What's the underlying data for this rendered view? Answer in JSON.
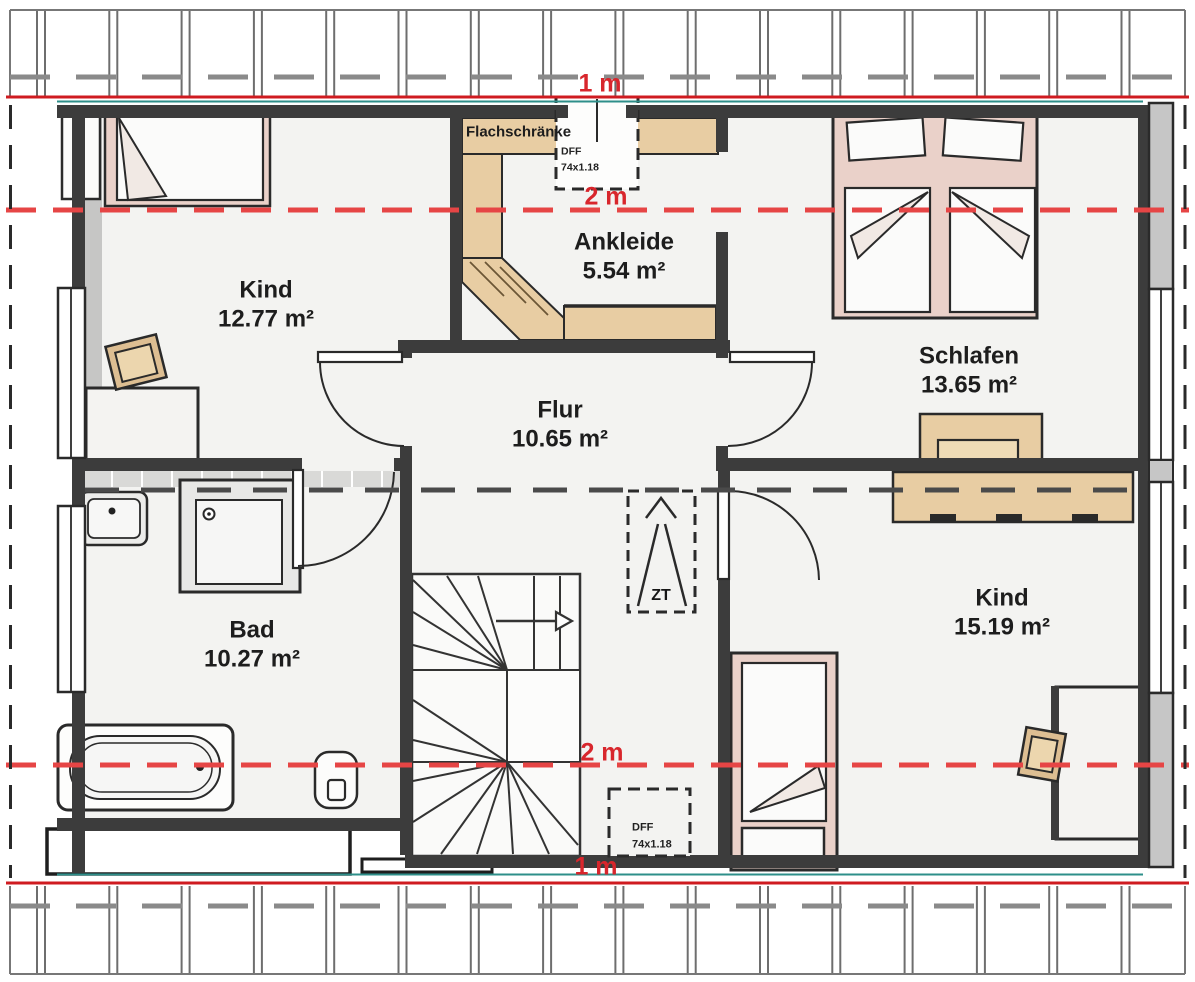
{
  "rooms": [
    {
      "name": "Kind",
      "area": "12.77 m²"
    },
    {
      "name": "Ankleide",
      "area": "5.54 m²"
    },
    {
      "name": "Schlafen",
      "area": "13.65 m²"
    },
    {
      "name": "Flur",
      "area": "10.65 m²"
    },
    {
      "name": "Bad",
      "area": "10.27 m²"
    },
    {
      "name": "Kind",
      "area": "15.19 m²"
    }
  ],
  "labels": {
    "flat_cabinets": "Flachschränke",
    "roof_hatch": "ZT"
  },
  "roof_windows": {
    "top": {
      "code": "DFF",
      "size": "74x1.18"
    },
    "bottom": {
      "code": "DFF",
      "size": "74x1.18"
    }
  },
  "height_marks": {
    "top_1m": "1 m",
    "top_2m": "2 m",
    "mid_2m": "2 m",
    "bottom_1m": "1 m"
  },
  "colors": {
    "red_solid": "#cf1b20",
    "red_dashed": "#e64545",
    "teal": "#2e8f8a",
    "wall": "#3c3c3c",
    "wood": "#e8cda3",
    "pink": "#ead1c9"
  }
}
